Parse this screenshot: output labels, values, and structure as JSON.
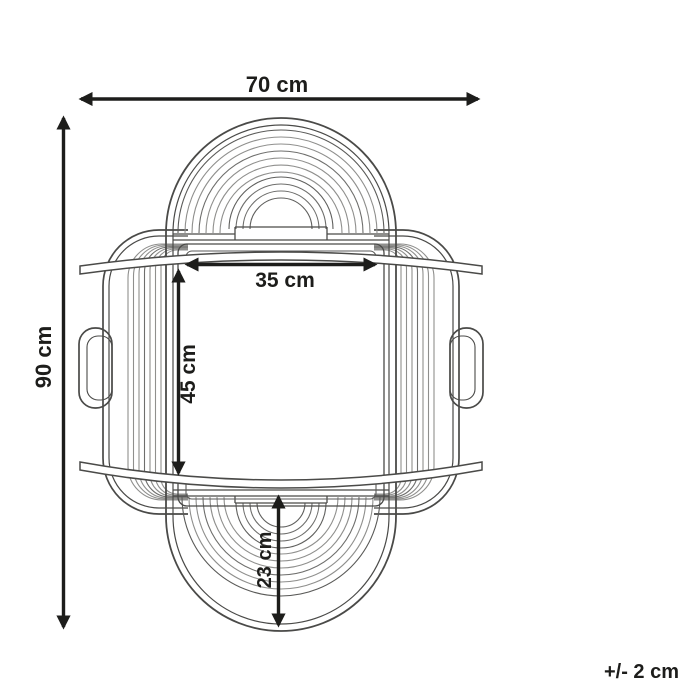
{
  "diagram": {
    "type": "furniture-dimension-drawing",
    "subject": "rattan chair front view line drawing",
    "tolerance_note": "+/- 2 cm",
    "dimensions": {
      "overall_width": {
        "label": "70 cm",
        "orientation": "horizontal",
        "position": "top"
      },
      "overall_height": {
        "label": "90 cm",
        "orientation": "vertical",
        "position": "left"
      },
      "seat_width": {
        "label": "35 cm",
        "orientation": "horizontal",
        "position": "seat-top"
      },
      "seat_height": {
        "label": "45 cm",
        "orientation": "vertical",
        "position": "seat-left"
      },
      "base_height": {
        "label": "23 cm",
        "orientation": "vertical",
        "position": "bottom-center"
      }
    },
    "colors": {
      "background": "#ffffff",
      "dimension_line": "#1d1d1b",
      "outline_dark": "#4a4a48",
      "outline_medium": "#6e6e6c",
      "outline_light": "#8f8f8d"
    }
  }
}
